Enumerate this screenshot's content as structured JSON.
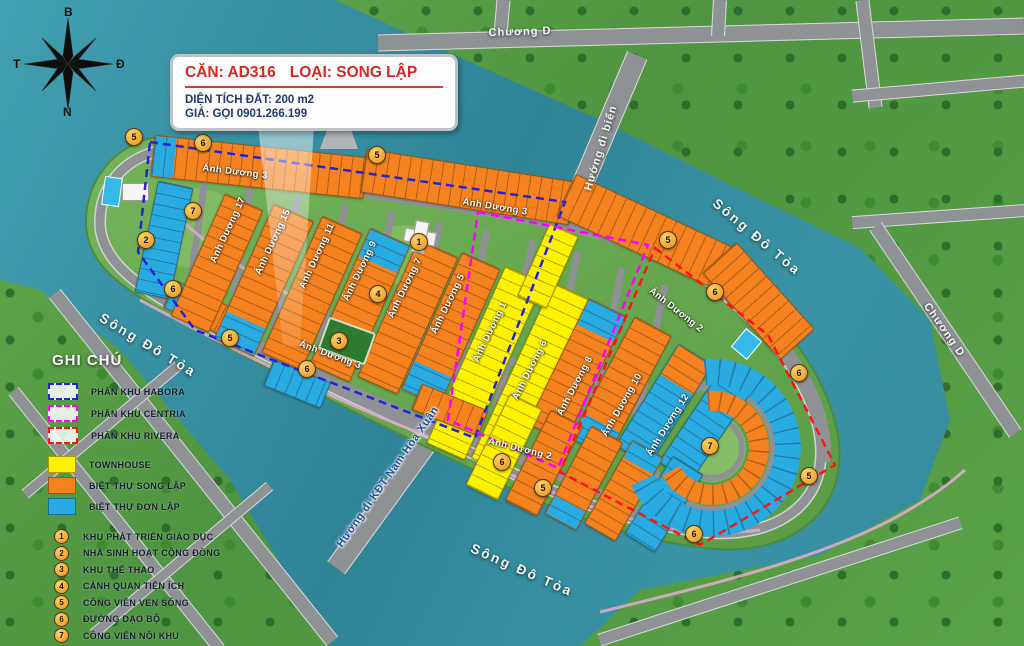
{
  "popup": {
    "can": "CĂN: AD316",
    "loai": "LOẠI: SONG LẬP",
    "dien_tich": "DIỆN TÍCH ĐẤT: 200 m2",
    "gia": "GIÁ: GỌI 0901.266.199"
  },
  "compass": {
    "north": "B",
    "south": "N",
    "west": "T",
    "east": "Đ"
  },
  "legend": {
    "title": "GHI CHÚ",
    "zones": [
      {
        "label": "PHÂN KHU HABORA",
        "color": "#2323D8"
      },
      {
        "label": "PHÂN KHU CENTRIA",
        "color": "#FF00FF"
      },
      {
        "label": "PHÂN KHU RIVERA",
        "color": "#FF1414"
      }
    ],
    "types": [
      {
        "label": "TOWNHOUSE",
        "color": "#FFF200"
      },
      {
        "label": "BIỆT THỰ SONG LẬP",
        "color": "#F5821F"
      },
      {
        "label": "BIỆT THỰ ĐƠN LẬP",
        "color": "#29ABE2"
      }
    ],
    "amenities": [
      {
        "num": "1",
        "label": "KHU PHÁT TRIỂN GIÁO DỤC"
      },
      {
        "num": "2",
        "label": "NHÀ SINH HOẠT CỘNG ĐỒNG"
      },
      {
        "num": "3",
        "label": "KHU THỂ THAO"
      },
      {
        "num": "4",
        "label": "CẢNH QUAN TIỆN ÍCH"
      },
      {
        "num": "5",
        "label": "CÔNG VIÊN VEN SÔNG"
      },
      {
        "num": "6",
        "label": "ĐƯỜNG DẠO BỘ"
      },
      {
        "num": "7",
        "label": "CÔNG VIÊN NỘI KHU"
      }
    ]
  },
  "waterways": {
    "river": "Sông Đô Tỏa",
    "chuong_d": "Chương D",
    "bridge_sea": "Hướng đi biển",
    "bridge_kdt": "Hướng đi KĐT Nam Hòa Xuân"
  },
  "streets": {
    "ad1": "Ánh Dương 1",
    "ad2": "Ánh Dương 2",
    "ad3": "Ánh Dương 3",
    "ad5": "Ánh Dương 5",
    "ad6": "Ánh Dương 6",
    "ad7": "Ánh Dương 7",
    "ad8": "Ánh Dương 8",
    "ad9": "Ánh Dương 9",
    "ad10": "Ánh Dương 10",
    "ad11": "Ánh Dương 11",
    "ad12": "Ánh Dương 12",
    "ad15": "Ánh Dương 15",
    "ad17": "Ánh Dương 17"
  },
  "markers": [
    "5",
    "6",
    "5",
    "7",
    "2",
    "1",
    "5",
    "6",
    "6",
    "4",
    "5",
    "3",
    "6",
    "6",
    "7",
    "5",
    "6",
    "5",
    "6"
  ],
  "colors": {
    "water": "#3A94A6",
    "grass": "#5aa247",
    "road": "#8f9295",
    "townhouse": "#FFF200",
    "song_lap": "#F5821F",
    "don_lap": "#29ABE2",
    "habora": "#2323D8",
    "centria": "#FF00FF",
    "rivera": "#FF1414",
    "popup_title": "#D42A22",
    "popup_text": "#1E3A6E"
  }
}
